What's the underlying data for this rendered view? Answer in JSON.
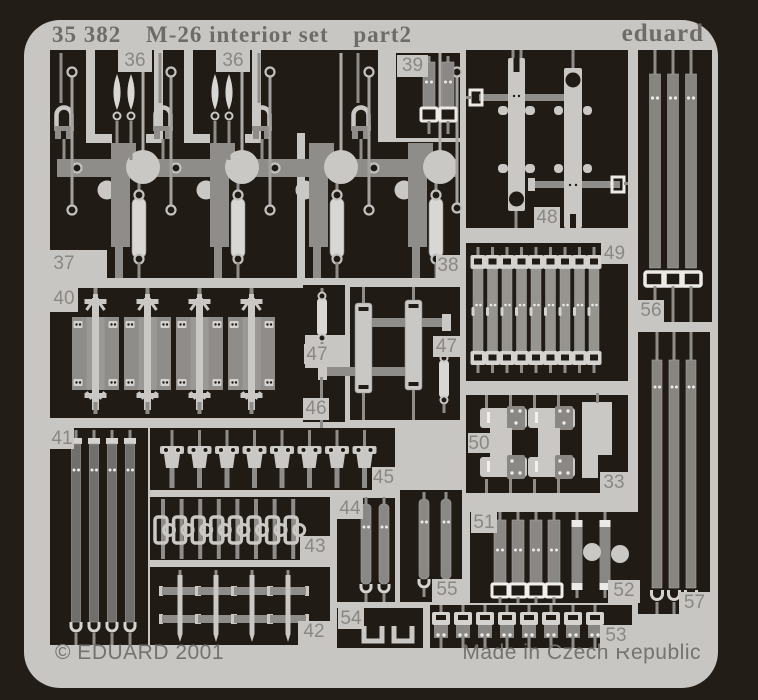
{
  "header": {
    "catalog": "35 382",
    "title": "M-26 interior set",
    "part": "part2",
    "brand": "eduard"
  },
  "footer": {
    "copyright": "© EDUARD 2001",
    "origin": "Made in Czech Republic"
  },
  "sections": [
    {
      "id": "36a",
      "label": "36"
    },
    {
      "id": "36b",
      "label": "36"
    },
    {
      "id": "37",
      "label": "37"
    },
    {
      "id": "38",
      "label": "38"
    },
    {
      "id": "39",
      "label": "39"
    },
    {
      "id": "40",
      "label": "40"
    },
    {
      "id": "41",
      "label": "41"
    },
    {
      "id": "42",
      "label": "42"
    },
    {
      "id": "43",
      "label": "43"
    },
    {
      "id": "44",
      "label": "44"
    },
    {
      "id": "45",
      "label": "45"
    },
    {
      "id": "46",
      "label": "46"
    },
    {
      "id": "47a",
      "label": "47"
    },
    {
      "id": "47b",
      "label": "47"
    },
    {
      "id": "48",
      "label": "48"
    },
    {
      "id": "49",
      "label": "49"
    },
    {
      "id": "50",
      "label": "50"
    },
    {
      "id": "51",
      "label": "51"
    },
    {
      "id": "52",
      "label": "52"
    },
    {
      "id": "53",
      "label": "53"
    },
    {
      "id": "54",
      "label": "54"
    },
    {
      "id": "55",
      "label": "55"
    },
    {
      "id": "56",
      "label": "56"
    },
    {
      "id": "57",
      "label": "57"
    },
    {
      "id": "33",
      "label": "33"
    }
  ],
  "colors": {
    "background": "#231d18",
    "sheet": "#c7c6c3",
    "cutout": "#211b16",
    "part_light": "#c9c8c5",
    "part_bright": "#d8d7d4",
    "part_medium": "#8f8d8a",
    "part_dark": "#716f6c",
    "accent_white": "#eceae7",
    "label_text": "#8a8882",
    "header_text": "#6e6c69"
  }
}
